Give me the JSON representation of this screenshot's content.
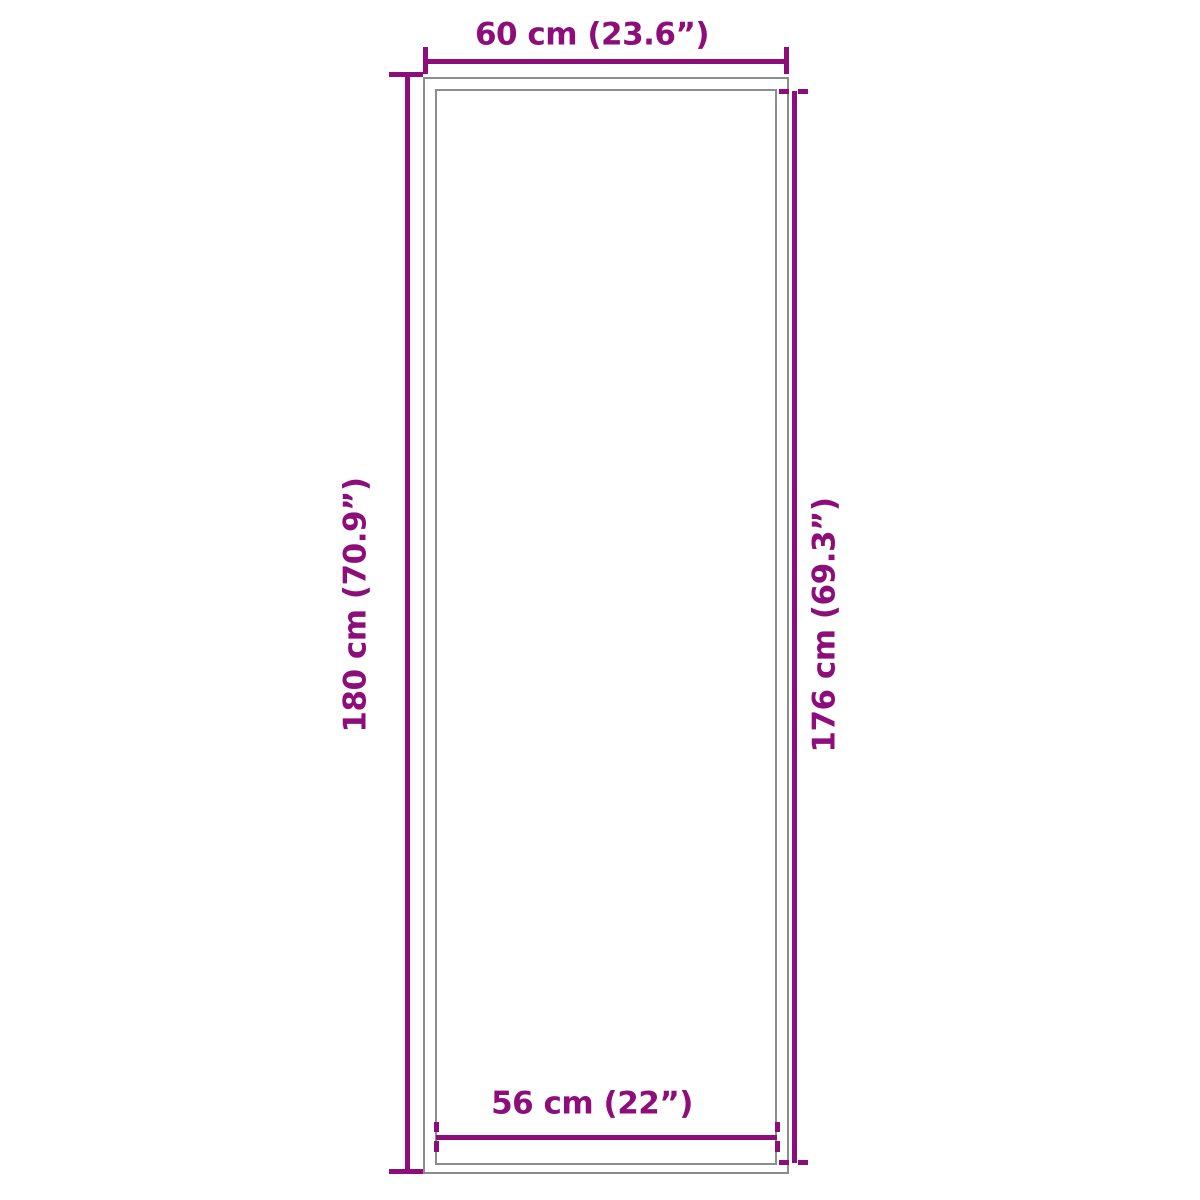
{
  "diagram": {
    "type": "product-dimension-diagram",
    "colors": {
      "dimension_accent": "#8d0e7b",
      "outline_gray": "#8c8c8c",
      "background": "#ffffff"
    },
    "dimensions": {
      "outer_width": {
        "label": "60 cm (23.6”)"
      },
      "outer_height": {
        "label": "180 cm (70.9”)"
      },
      "inner_height": {
        "label": "176 cm (69.3”)"
      },
      "inner_width": {
        "label": "56 cm (22”)"
      }
    }
  }
}
